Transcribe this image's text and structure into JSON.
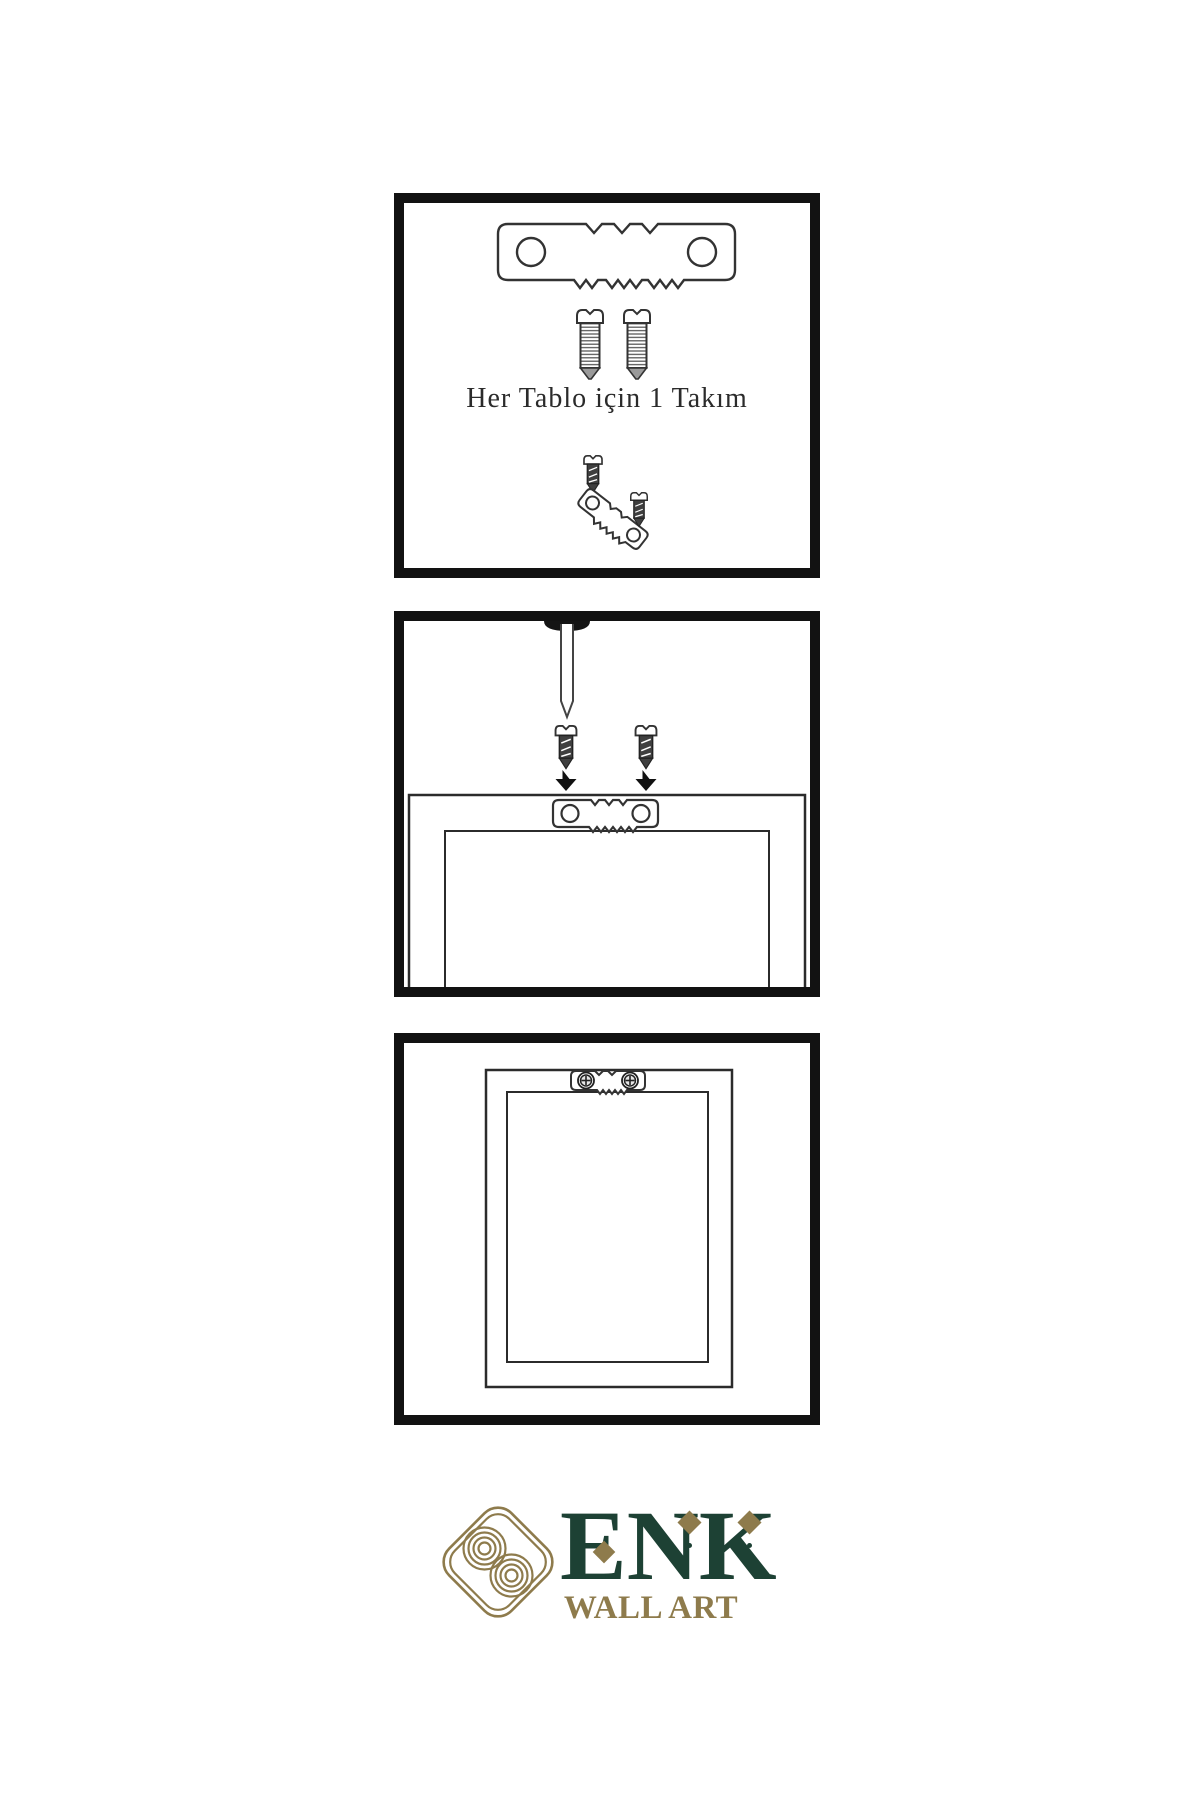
{
  "document": {
    "type": "wall-art-hanging-instructions",
    "language": "tr",
    "background": "#ffffff"
  },
  "steps": [
    {
      "id": "hardware-kit",
      "caption": "Her Tablo için 1 Takım",
      "depicts": [
        "sawtooth-hanger",
        "screw",
        "screw",
        "small-screw",
        "tilted-sawtooth-hanger",
        "small-screw"
      ]
    },
    {
      "id": "attach-hanger-to-frame-back",
      "depicts": [
        "wall-nail",
        "screw",
        "screw",
        "down-arrow",
        "down-arrow",
        "frame-back",
        "sawtooth-hanger"
      ]
    },
    {
      "id": "frame-hung-on-wall",
      "depicts": [
        "frame-back",
        "mounted-sawtooth-hanger-with-screws"
      ]
    }
  ],
  "brand": {
    "name": "ENK",
    "tagline": "WALL ART",
    "colors": {
      "green": "#1d4134",
      "gold": "#8e7b4c"
    }
  },
  "colors": {
    "panel_border": "#121212",
    "line_art": "#333333",
    "caption_text": "#2b2b2b",
    "screw_dark_fill": "#3f3f3f"
  },
  "icons": {
    "sawtooth-hanger-icon": "svg-plate-with-teeth",
    "screw-icon": "svg-threaded-screw",
    "dark-screw-icon": "svg-dark-screw",
    "wall-nail-icon": "svg-nail",
    "down-arrow-icon": "svg-solid-arrow",
    "phillips-head-icon": "svg-circle-cross",
    "knot-logo-icon": "svg-concentric-knot",
    "diamond-icon": "css-rotated-square"
  }
}
